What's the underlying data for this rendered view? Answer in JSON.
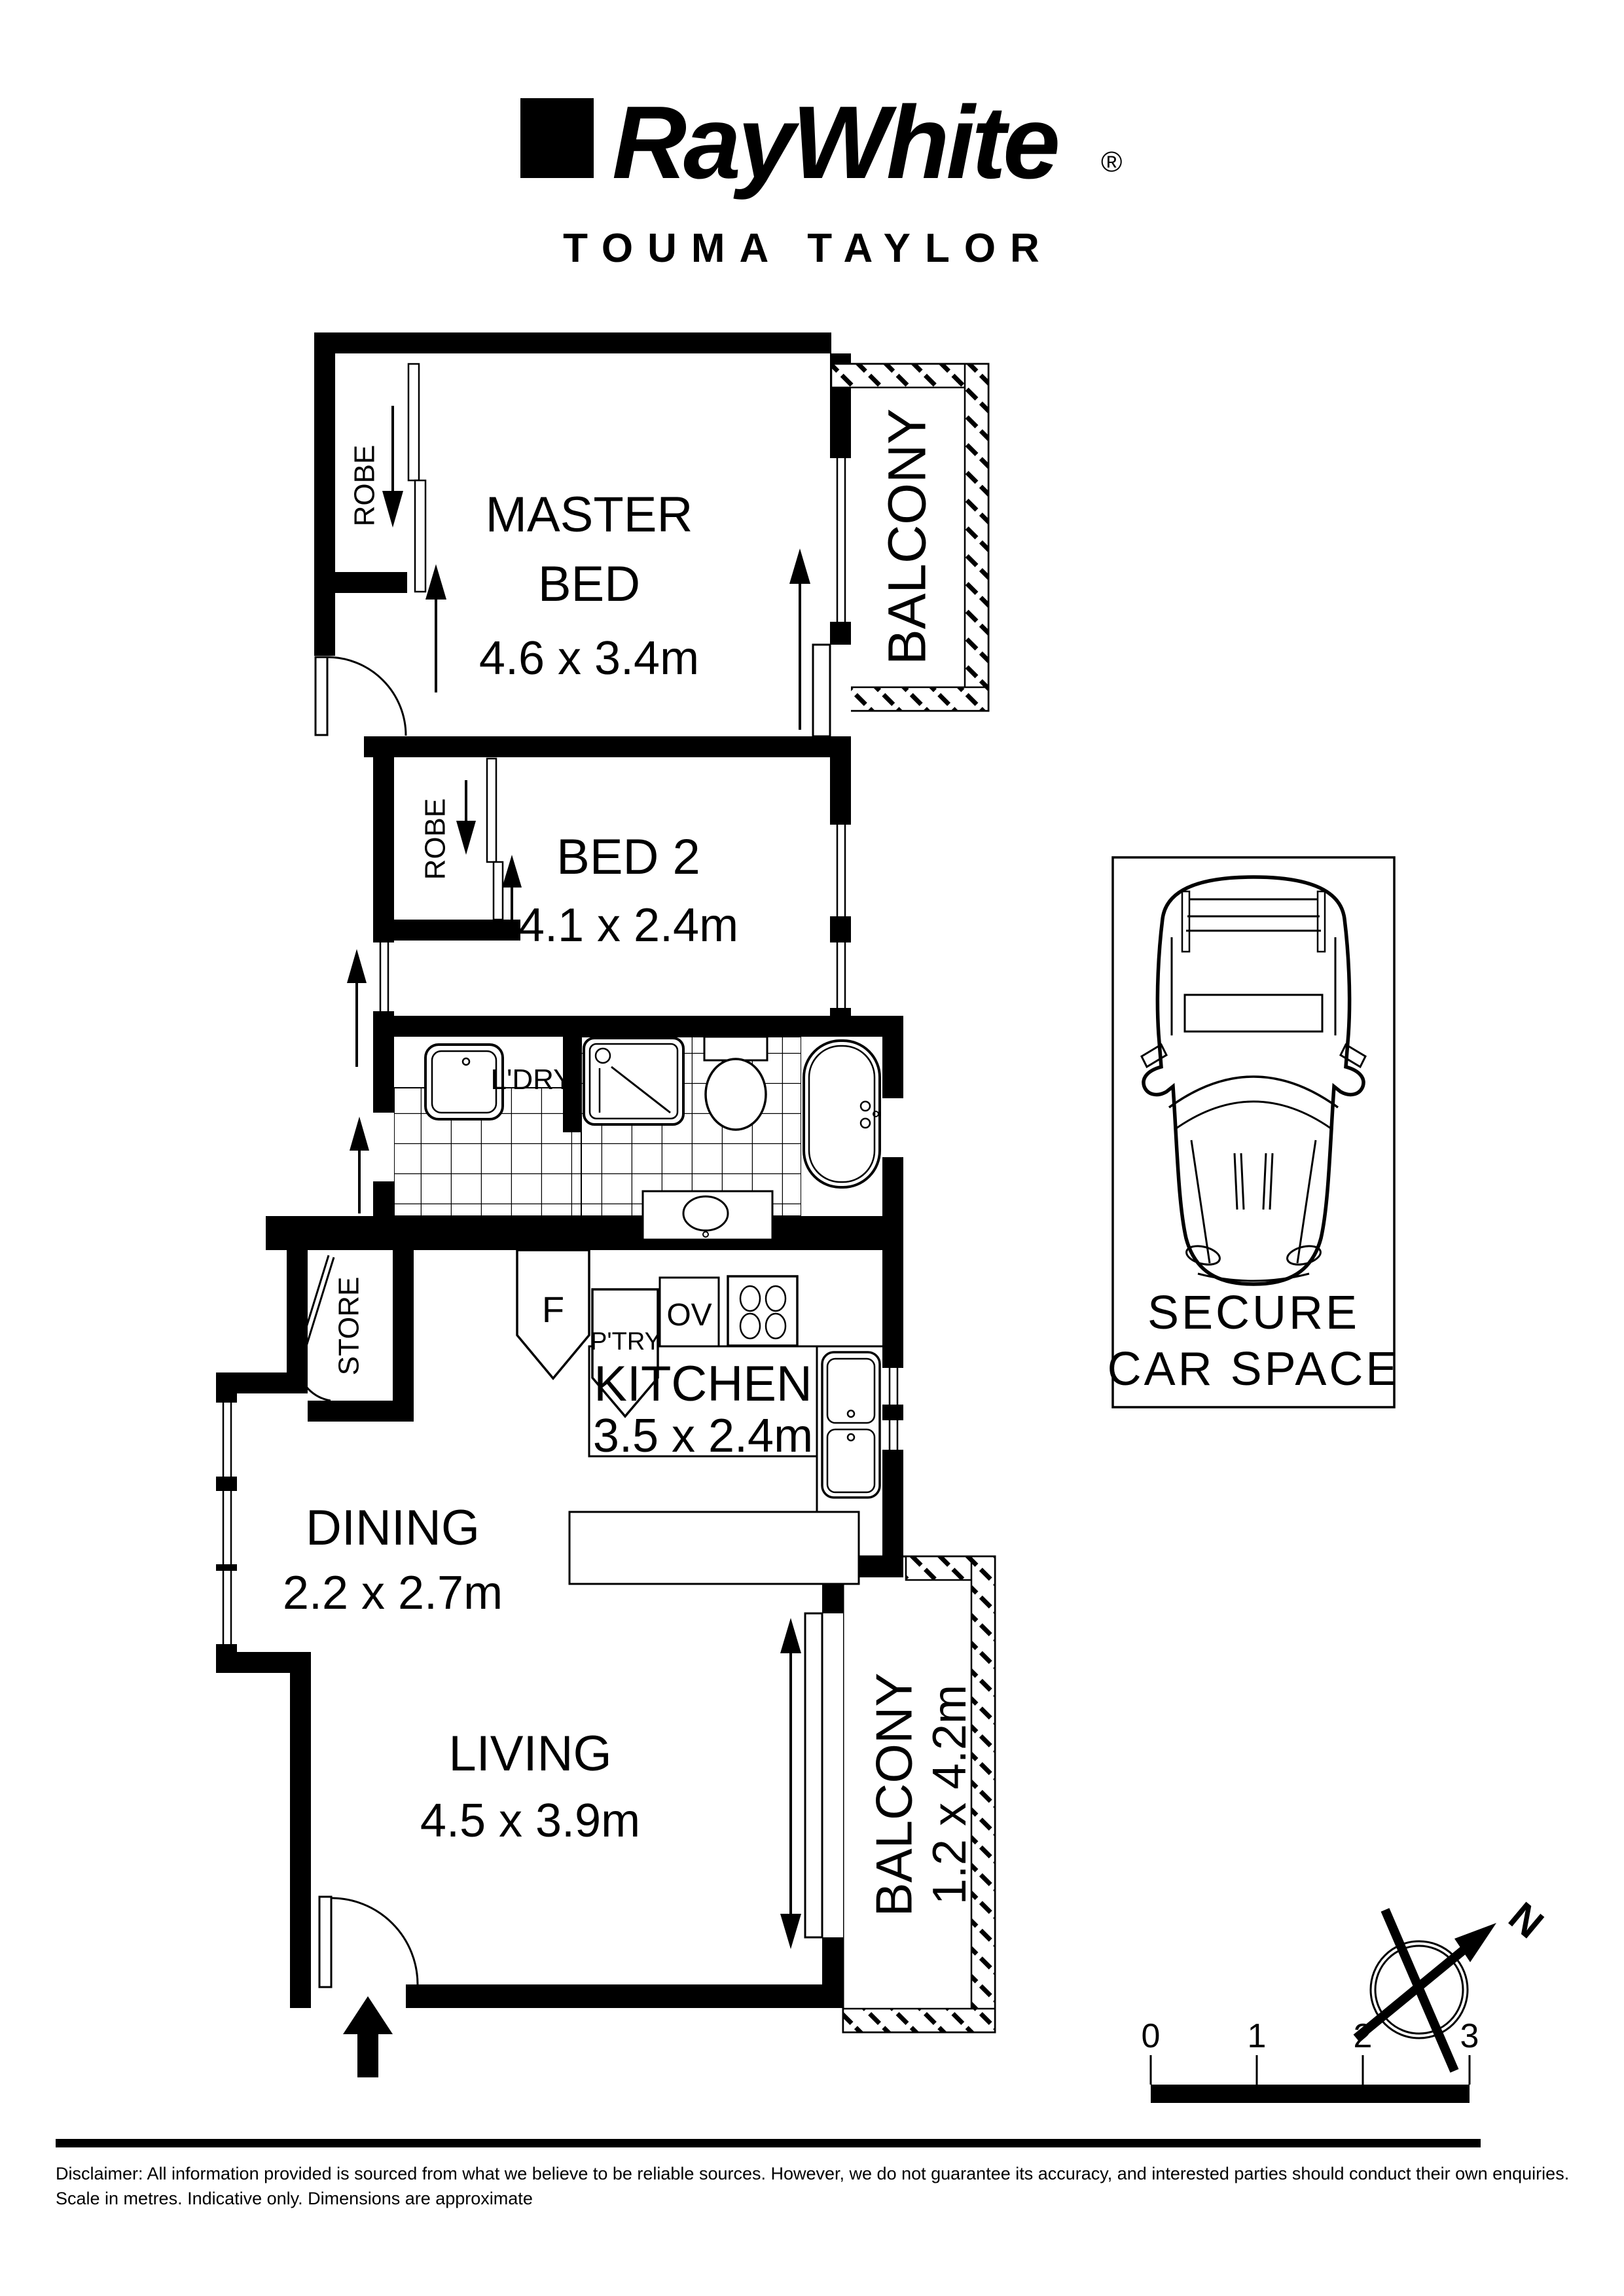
{
  "header": {
    "brand": "RayWhite",
    "registered": "®",
    "agency": "TOUMA TAYLOR"
  },
  "rooms": {
    "master": {
      "line1": "MASTER",
      "line2": "BED",
      "dims": "4.6 x 3.4m"
    },
    "bed2": {
      "name": "BED 2",
      "dims": "4.1 x 2.4m"
    },
    "kitchen": {
      "name": "KITCHEN",
      "dims": "3.5 x 2.4m"
    },
    "dining": {
      "name": "DINING",
      "dims": "2.2 x 2.7m"
    },
    "living": {
      "name": "LIVING",
      "dims": "4.5 x 3.9m"
    },
    "balcony_top": {
      "name": "BALCONY"
    },
    "balcony_bottom": {
      "name": "BALCONY",
      "dims": "1.2 x 4.2m"
    },
    "robe_master": {
      "name": "ROBE"
    },
    "robe_bed2": {
      "name": "ROBE"
    },
    "store": {
      "name": "STORE"
    },
    "laundry": {
      "name": "L'DRY"
    }
  },
  "fixtures": {
    "fridge": "F",
    "pantry": "P'TRY",
    "oven": "OV"
  },
  "car_space": {
    "line1": "SECURE",
    "line2": "CAR SPACE"
  },
  "compass": {
    "north": "N"
  },
  "scale_bar": {
    "labels": [
      "0",
      "1",
      "2",
      "3"
    ]
  },
  "footer": {
    "line1": "Disclaimer: All information provided is sourced from what we believe to be reliable sources. However, we do not guarantee  its accuracy, and interested parties should conduct their own enquiries.",
    "line2": "Scale in metres. Indicative only. Dimensions are approximate"
  },
  "colors": {
    "ink": "#000000",
    "paper": "#ffffff"
  }
}
